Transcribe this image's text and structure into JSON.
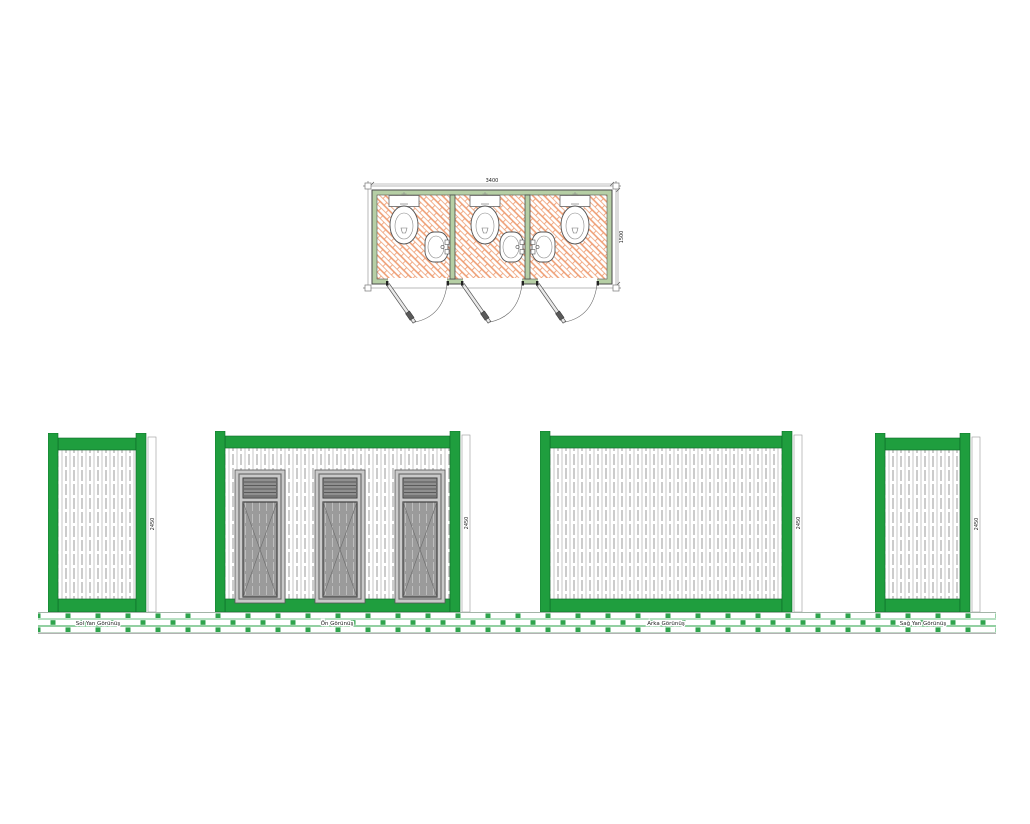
{
  "drawing": {
    "type": "prefab-container-wc-technical-drawing",
    "stall_count": 3
  },
  "plan": {
    "dim_width_mm": "3400",
    "dim_depth_mm": "1500",
    "fixture_icons": {
      "toilet": "toilet-plan-symbol",
      "sink": "sink-plan-symbol",
      "door": "door-swing-symbol"
    }
  },
  "elevations": {
    "left": {
      "label": "Sol Yan Görünüş",
      "dim_height_mm": "2450"
    },
    "front": {
      "label": "Ön Görünüş",
      "dim_height_mm": "2450"
    },
    "back": {
      "label": "Arka Görünüş",
      "dim_height_mm": "2450"
    },
    "right": {
      "label": "Sağ Yan Görünüş",
      "dim_height_mm": "2450"
    }
  },
  "colors": {
    "frame_green": "#1f9e3e",
    "plan_wall_green": "#b6cfa5",
    "tile_orange": "#ee9a6e",
    "door_gray": "#9b9b9b",
    "ground_joint_green": "#2fa44d"
  }
}
